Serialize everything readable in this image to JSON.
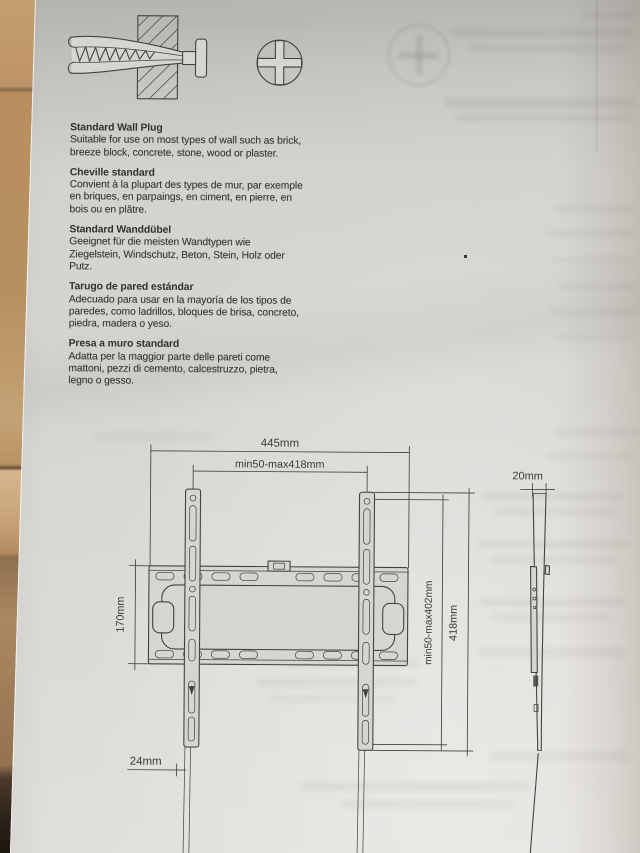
{
  "illustration": {
    "icons": [
      {
        "name": "wall-plug-cross-section"
      },
      {
        "name": "phillips-screw-head"
      }
    ]
  },
  "sections": [
    {
      "lang": "en",
      "title": "Standard Wall Plug",
      "body": "Suitable for use on most types of wall such as brick,\nbreeze block, concrete, stone, wood or plaster."
    },
    {
      "lang": "fr",
      "title": "Cheville standard",
      "body": "Convient à la plupart des types de mur, par exemple\nen briques, en parpaings, en ciment, en pierre, en\nbois ou en plâtre."
    },
    {
      "lang": "de",
      "title": "Standard Wanddübel",
      "body": "Geeignet für die meisten Wandtypen wie\nZiegelstein, Windschutz, Beton, Stein, Holz oder\nPutz."
    },
    {
      "lang": "es",
      "title": "Tarugo de pared estándar",
      "body": "Adecuado para usar en la mayoría de los tipos de\nparedes, como ladrillos, bloques de brisa, concreto,\npiedra, madera o yeso."
    },
    {
      "lang": "it",
      "title": "Presa a muro standard",
      "body": "Adatta per la maggior parte delle pareti come\nmattoni, pezzi di cemento, calcestruzzo, pietra,\nlegno o gesso."
    }
  ],
  "diagram": {
    "labels": {
      "overall_width": "445mm",
      "mount_width_range": "min50-max418mm",
      "side_depth": "20mm",
      "plate_height": "170mm",
      "mount_height_range": "min50-max402mm",
      "bracket_height": "418mm",
      "rail_width": "24mm"
    }
  },
  "colors": {
    "paper": "#d6d5d1",
    "wood": "#b08a5e",
    "ink": "#45433e",
    "text": "#3a3834"
  }
}
